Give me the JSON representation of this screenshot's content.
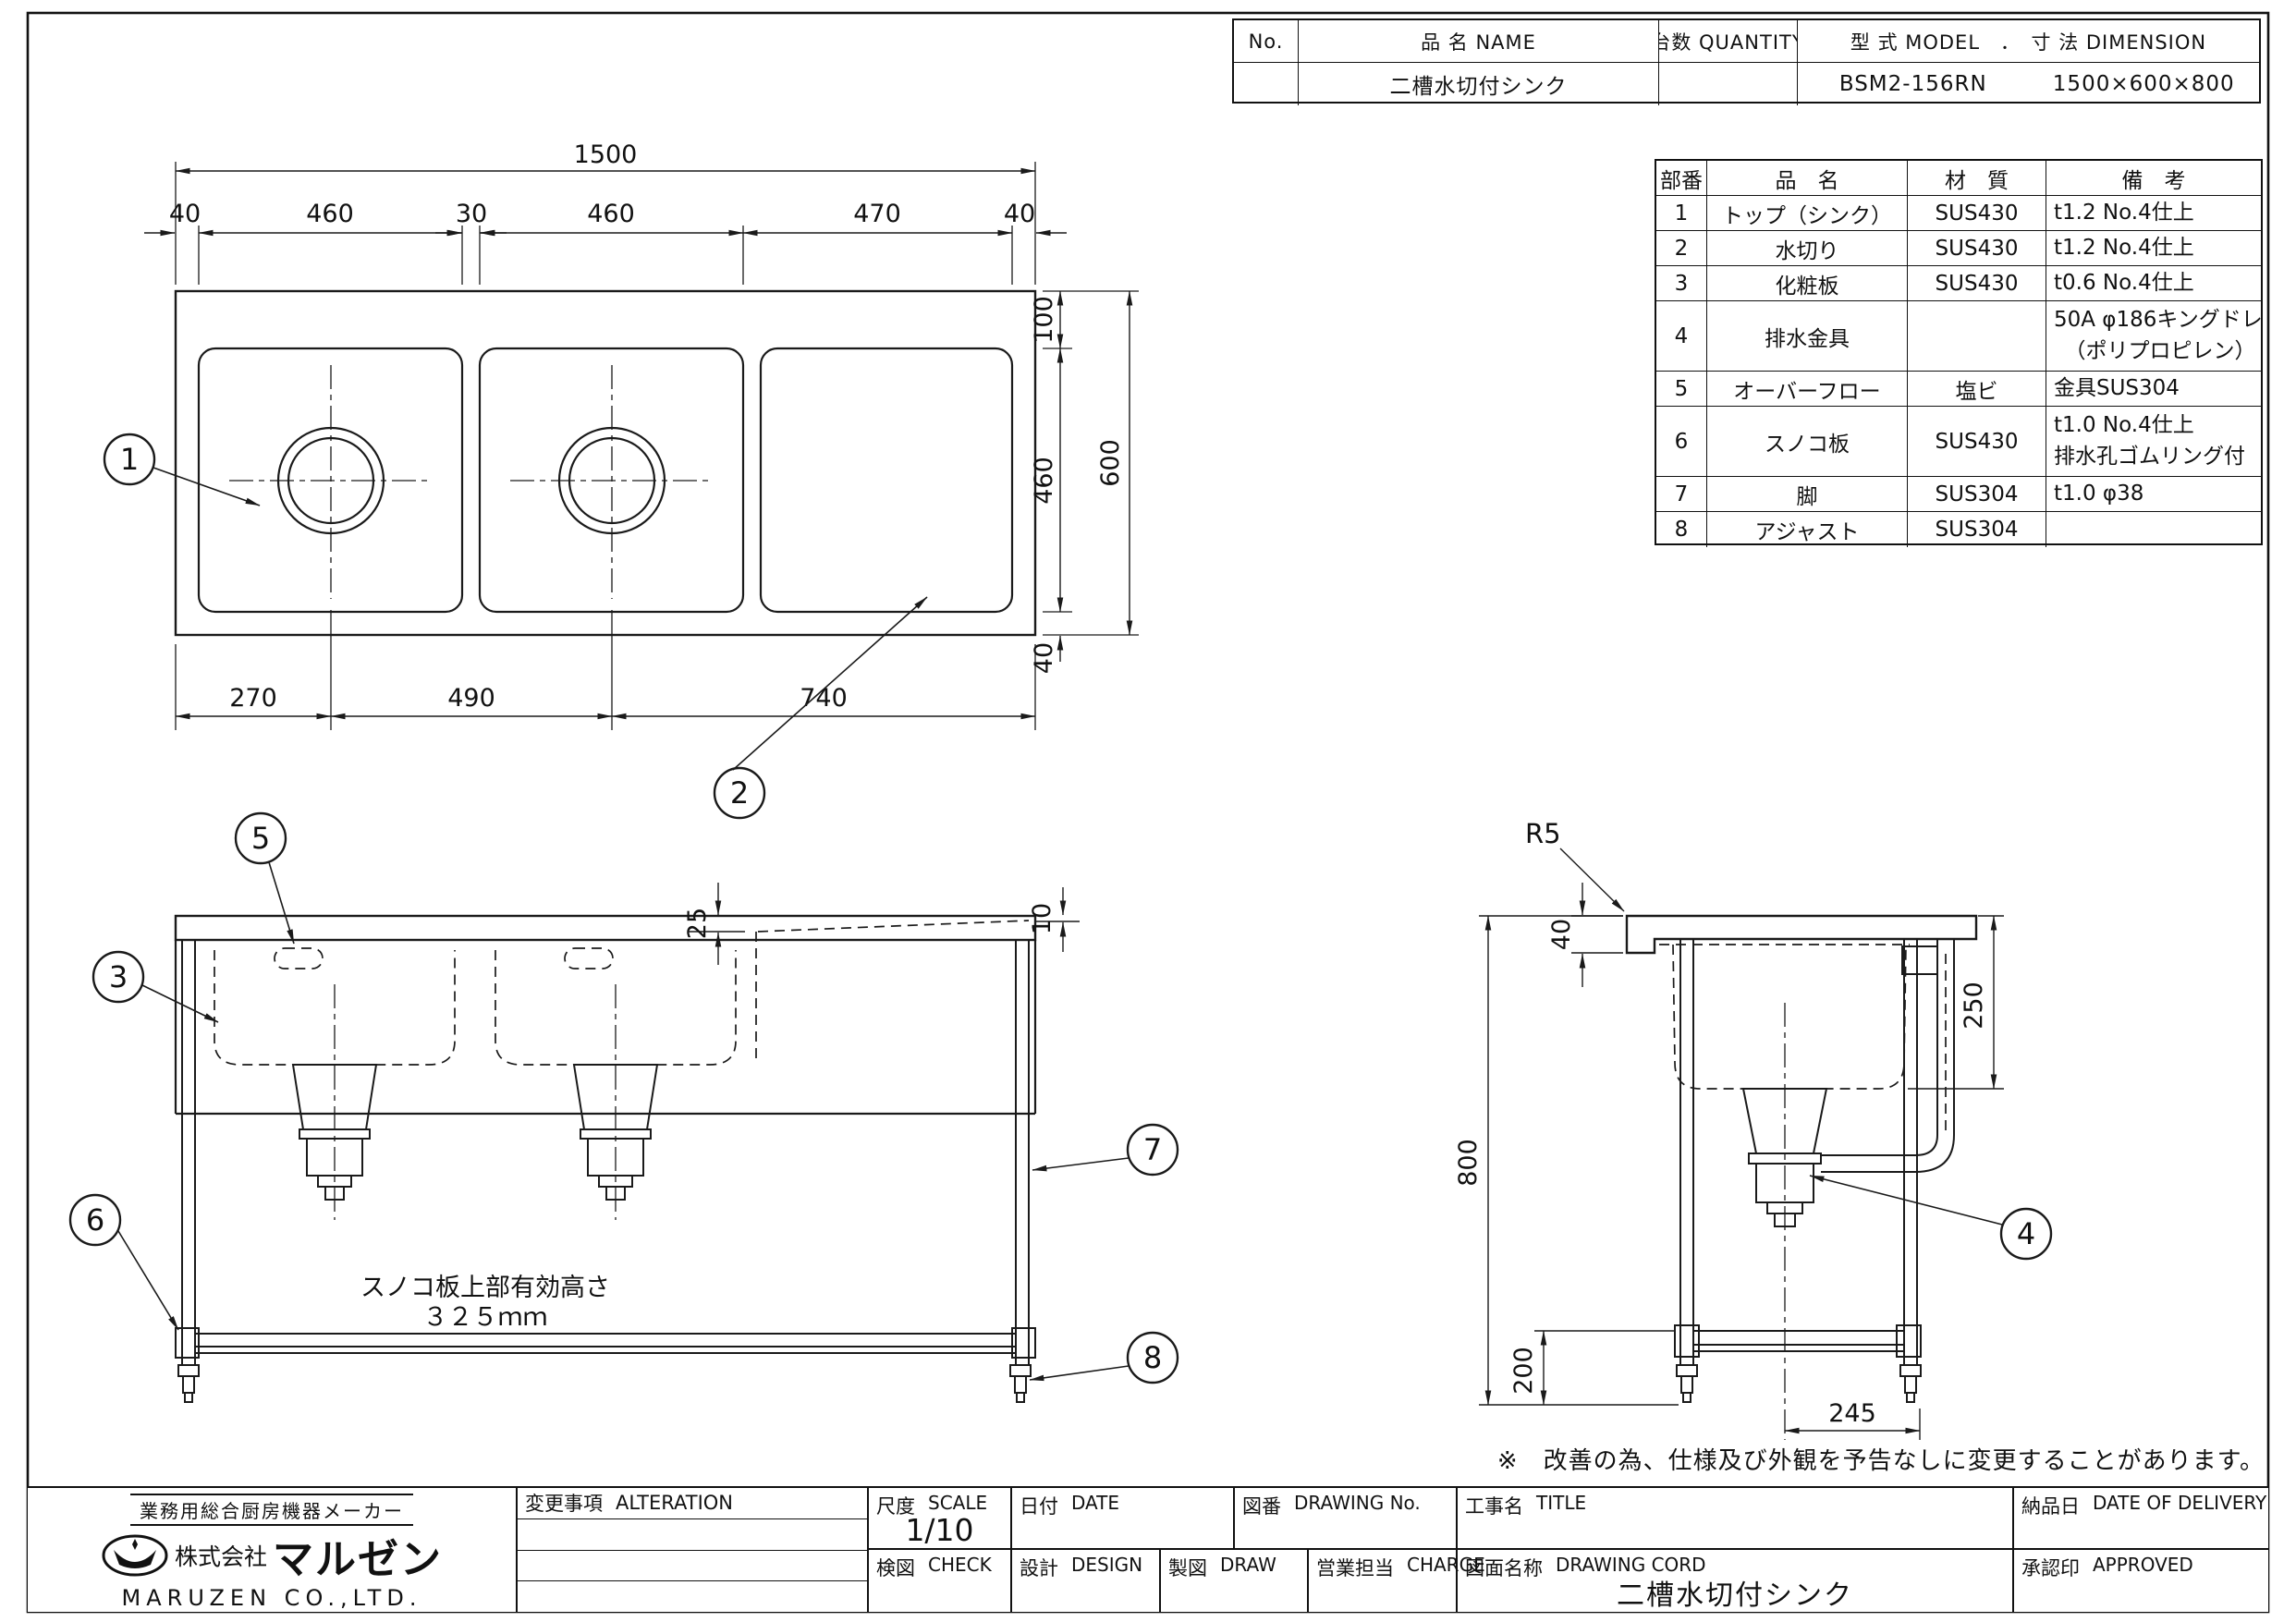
{
  "header_table": {
    "no_label": "No.",
    "name_label": "品 名  NAME",
    "qty_label": "台数  QUANTITY",
    "model_dim_label": "型 式  MODEL　．　寸 法  DIMENSION",
    "name_value": "二槽水切付シンク",
    "qty_value": "",
    "model_value": "BSM2-156RN",
    "dimension_value": "1500×600×800"
  },
  "parts_table": {
    "col_no": "部番",
    "col_name": "品　名",
    "col_material": "材　質",
    "col_remarks": "備　考",
    "rows": [
      {
        "no": "1",
        "name": "トップ（シンク）",
        "material": "SUS430",
        "remarks": "t1.2 No.4仕上"
      },
      {
        "no": "2",
        "name": "水切り",
        "material": "SUS430",
        "remarks": "t1.2 No.4仕上"
      },
      {
        "no": "3",
        "name": "化粧板",
        "material": "SUS430",
        "remarks": "t0.6 No.4仕上"
      },
      {
        "no": "4",
        "name": "排水金具",
        "material": "",
        "remarks": "50A φ186キングドレン\n　（ポリプロピレン）"
      },
      {
        "no": "5",
        "name": "オーバーフロー",
        "material": "塩ビ",
        "remarks": "金具SUS304"
      },
      {
        "no": "6",
        "name": "スノコ板",
        "material": "SUS430",
        "remarks": "t1.0 No.4仕上\n排水孔ゴムリング付"
      },
      {
        "no": "7",
        "name": "脚",
        "material": "SUS304",
        "remarks": "t1.0 φ38"
      },
      {
        "no": "8",
        "name": "アジャスト",
        "material": "SUS304",
        "remarks": ""
      }
    ]
  },
  "dims": {
    "plan_overall_width": "1500",
    "plan_40_left": "40",
    "plan_460_left": "460",
    "plan_30": "30",
    "plan_460_right": "460",
    "plan_470": "470",
    "plan_40_right": "40",
    "plan_270": "270",
    "plan_490": "490",
    "plan_740": "740",
    "plan_100": "100",
    "plan_460_side": "460",
    "plan_40_bottom": "40",
    "plan_overall_depth": "600",
    "front_25": "25",
    "front_10": "10",
    "side_r5": "R5",
    "side_40": "40",
    "side_800": "800",
    "side_250": "250",
    "side_200": "200",
    "side_245": "245"
  },
  "balloons": {
    "b1": "1",
    "b2": "2",
    "b3": "3",
    "b4": "4",
    "b5": "5",
    "b6": "6",
    "b7": "7",
    "b8": "8"
  },
  "notes": {
    "slat_line1": "スノコ板上部有効高さ",
    "slat_line2": "３２５ｍｍ",
    "footnote": "※　改善の為、仕様及び外観を予告なしに変更することがあります。"
  },
  "title_block": {
    "maker_tagline": "業務用総合厨房機器メーカー",
    "company_prefix": "株式会社",
    "company_name": "マルゼン",
    "company_en": "MARUZEN CO.,LTD.",
    "alteration_label": "変更事項",
    "alteration_en": "ALTERATION",
    "scale_label": "尺度",
    "scale_en": "SCALE",
    "scale_value": "1/10",
    "date_label": "日付",
    "date_en": "DATE",
    "drawing_no_label": "図番",
    "drawing_no_en": "DRAWING No.",
    "project_label": "工事名",
    "project_en": "TITLE",
    "check_label": "検図",
    "check_en": "CHECK",
    "design_label": "設計",
    "design_en": "DESIGN",
    "draw_label": "製図",
    "draw_en": "DRAW",
    "charge_label": "営業担当",
    "charge_en": "CHARGE",
    "drawing_name_label": "図面名称",
    "drawing_name_en": "DRAWING CORD",
    "drawing_name_value": "二槽水切付シンク",
    "delivery_label": "納品日",
    "delivery_en": "DATE OF DELIVERY",
    "approved_label": "承認印",
    "approved_en": "APPROVED"
  }
}
